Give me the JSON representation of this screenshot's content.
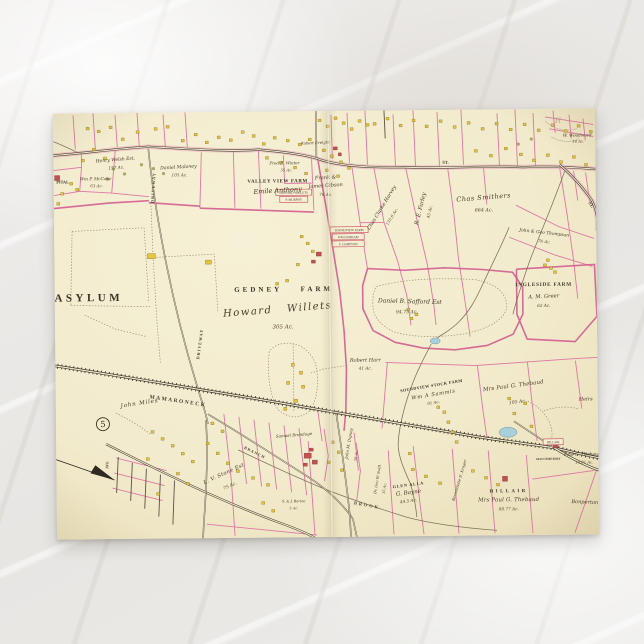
{
  "scene": {
    "description": "vintage atlas map postcard on white marble surface",
    "colors": {
      "marble_background": "#e9e7e4",
      "paper": "#f2ebcd",
      "parcel_pink": "#df76a3",
      "building_yellow": "#e8c43c",
      "building_red": "#c2504f",
      "water_blue": "#a8d0dc",
      "road_dark": "#4a4234"
    }
  },
  "postcard": {
    "kind": "vintage-atlas-map-postcard",
    "plate_number": "5"
  },
  "map": {
    "plate_number": "5",
    "labels": [
      {
        "id": "asylum",
        "t": "ASYLUM",
        "x": 34,
        "y": 188,
        "fs": 11,
        "ls": 3.5,
        "cls": "c"
      },
      {
        "id": "gedney-farm",
        "t": "GEDNEY FARM",
        "x": 229,
        "y": 180,
        "fs": 7,
        "ls": 3,
        "ws": 14,
        "cls": "c"
      },
      {
        "id": "howard-willets",
        "t": "Howard Willets",
        "x": 223,
        "y": 201,
        "fs": 10,
        "ls": 1.5,
        "ws": 10,
        "rot": -4,
        "cls": "s"
      },
      {
        "id": "gedney-acre",
        "t": "305 Ac.",
        "x": 228,
        "y": 217,
        "fs": 5.5,
        "cls": "a"
      },
      {
        "id": "valley-view-farm",
        "t": "VALLEY VIEW FARM",
        "x": 224,
        "y": 71,
        "fs": 5,
        "ls": 0.6,
        "cls": "c"
      },
      {
        "id": "emile-anthony",
        "t": "Emile Anthony",
        "x": 224,
        "y": 81,
        "fs": 6.5,
        "rot": -3,
        "cls": "s"
      },
      {
        "id": "henry-welsh",
        "t": "Henry Welsh Est.",
        "x": 62,
        "y": 48,
        "fs": 4.5,
        "rot": -4,
        "cls": "s"
      },
      {
        "id": "henry-welsh-acre",
        "t": "157 Ac.",
        "x": 63,
        "y": 56,
        "fs": 4.2,
        "rot": -4,
        "cls": "a"
      },
      {
        "id": "daniel-maloney",
        "t": "Daniel Maloney",
        "x": 125,
        "y": 56,
        "fs": 4.6,
        "rot": -3,
        "cls": "s"
      },
      {
        "id": "maloney-acre",
        "t": "105 Ac.",
        "x": 126,
        "y": 64,
        "fs": 4.2,
        "cls": "a"
      },
      {
        "id": "mccabe",
        "t": "Wm P. McCabe",
        "x": 42,
        "y": 67,
        "fs": 4.2,
        "cls": "s"
      },
      {
        "id": "mccabe-acre",
        "t": "63 Ac.",
        "x": 43,
        "y": 74,
        "fs": 4,
        "cls": "a"
      },
      {
        "id": "hospital-frag",
        "t": "PITAL",
        "x": 9,
        "y": 70,
        "fs": 4.2,
        "cls": "c"
      },
      {
        "id": "winter",
        "t": "Fred E. Winter",
        "x": 231,
        "y": 53,
        "fs": 4,
        "cls": "s"
      },
      {
        "id": "winter-acre",
        "t": "55 Ac.",
        "x": 233,
        "y": 60,
        "fs": 3.8,
        "cls": "a"
      },
      {
        "id": "gibson-1",
        "t": "Frank &",
        "x": 272,
        "y": 68,
        "fs": 5,
        "rot": -3,
        "cls": "s"
      },
      {
        "id": "gibson-2",
        "t": "James Gibson",
        "x": 272,
        "y": 76,
        "fs": 5,
        "rot": -3,
        "cls": "s"
      },
      {
        "id": "gibson-acre",
        "t": "76 Ac.",
        "x": 272,
        "y": 85,
        "fs": 4.2,
        "cls": "a"
      },
      {
        "id": "creight",
        "t": "Robert Creight",
        "x": 262,
        "y": 33,
        "fs": 3.8,
        "rot": -2,
        "cls": "s"
      },
      {
        "id": "harvey",
        "t": "Chas Clarke Harvey",
        "x": 329,
        "y": 98,
        "fs": 5,
        "rot": -58,
        "cls": "s"
      },
      {
        "id": "harvey-acre",
        "t": "135.6 Ac.",
        "x": 339,
        "y": 107,
        "fs": 4,
        "rot": -58,
        "cls": "a"
      },
      {
        "id": "farley",
        "t": "R. E. Farley",
        "x": 368,
        "y": 99,
        "fs": 5.6,
        "rot": -76,
        "cls": "s"
      },
      {
        "id": "farley-acre",
        "t": "45 Ac.",
        "x": 377,
        "y": 102,
        "fs": 4.2,
        "rot": -76,
        "cls": "a"
      },
      {
        "id": "smithers",
        "t": "Chas Smithers",
        "x": 430,
        "y": 90,
        "fs": 6.5,
        "rot": -4,
        "ls": 0.5,
        "cls": "s"
      },
      {
        "id": "smithers-acre",
        "t": "664 Ac.",
        "x": 430,
        "y": 102,
        "fs": 4.8,
        "cls": "a"
      },
      {
        "id": "thompson",
        "t": "John & Geo Thompson",
        "x": 490,
        "y": 125,
        "fs": 4.4,
        "rot": 7,
        "cls": "s"
      },
      {
        "id": "thompson-acre",
        "t": "76 Ac.",
        "x": 490,
        "y": 134,
        "fs": 4,
        "rot": 7,
        "cls": "a"
      },
      {
        "id": "woodward",
        "t": "W. Woodward",
        "x": 524,
        "y": 28,
        "fs": 4.2,
        "cls": "s"
      },
      {
        "id": "woodward-acre",
        "t": "14 Ac.",
        "x": 525,
        "y": 34,
        "fs": 3.8,
        "cls": "a"
      },
      {
        "id": "ingleside-farm",
        "t": "INGLESIDE FARM",
        "x": 489,
        "y": 177,
        "fs": 5.2,
        "ls": 0.8,
        "cls": "c"
      },
      {
        "id": "greer",
        "t": "A. M. Greer",
        "x": 489,
        "y": 189,
        "fs": 5.2,
        "rot": -2,
        "cls": "s"
      },
      {
        "id": "greer-acre",
        "t": "62 Ac.",
        "x": 489,
        "y": 198,
        "fs": 4.2,
        "cls": "a"
      },
      {
        "id": "safford",
        "t": "Daniel B. Safford Est",
        "x": 355,
        "y": 193,
        "fs": 6,
        "rot": 2,
        "cls": "s"
      },
      {
        "id": "safford-acre",
        "t": "94.75 Ac.",
        "x": 352,
        "y": 203,
        "fs": 4.6,
        "cls": "a"
      },
      {
        "id": "harr",
        "t": "Robert Harr",
        "x": 310,
        "y": 251,
        "fs": 5,
        "cls": "s"
      },
      {
        "id": "harr-acre",
        "t": "41 Ac.",
        "x": 310,
        "y": 259,
        "fs": 4.2,
        "cls": "a"
      },
      {
        "id": "soundview",
        "t": "SOUNDVIEW STOCK FARM",
        "x": 376,
        "y": 277,
        "fs": 4.2,
        "ls": 0.4,
        "rot": -9,
        "cls": "c"
      },
      {
        "id": "sammis",
        "t": "Wm A Sammis",
        "x": 378,
        "y": 286,
        "fs": 5.2,
        "ls": 0.6,
        "rot": -9,
        "cls": "s"
      },
      {
        "id": "sammis-acre",
        "t": "91 Ac.",
        "x": 378,
        "y": 294,
        "fs": 4,
        "rot": -9,
        "cls": "a"
      },
      {
        "id": "thebaud-n",
        "t": "Mrs Paul G. Thebaud",
        "x": 458,
        "y": 278,
        "fs": 5.4,
        "ls": 0.2,
        "rot": -7,
        "cls": "s"
      },
      {
        "id": "thebaud-n-acre",
        "t": "195 Ac.",
        "x": 462,
        "y": 294,
        "fs": 4.6,
        "rot": -7,
        "cls": "a"
      },
      {
        "id": "heirs",
        "t": "Heirs",
        "x": 530,
        "y": 292,
        "fs": 5,
        "cls": "s"
      },
      {
        "id": "john-miles",
        "t": "John Miles",
        "x": 84,
        "y": 292,
        "fs": 5.6,
        "ls": 0.8,
        "rot": -8,
        "cls": "s"
      },
      {
        "id": "stone",
        "t": "L. V. Stone Est",
        "x": 168,
        "y": 363,
        "fs": 5.2,
        "ls": 0.4,
        "rot": -24,
        "cls": "s"
      },
      {
        "id": "stone-acre",
        "t": "75 Ac.",
        "x": 174,
        "y": 375,
        "fs": 4.4,
        "rot": -24,
        "cls": "a"
      },
      {
        "id": "glen-alla",
        "t": "GLEN ALLA",
        "x": 352,
        "y": 376,
        "fs": 4.2,
        "ls": 0.8,
        "rot": -7,
        "cls": "c"
      },
      {
        "id": "bayne",
        "t": "G. Bayne",
        "x": 352,
        "y": 384,
        "fs": 5.6,
        "rot": -7,
        "cls": "s"
      },
      {
        "id": "bayne-acre",
        "t": "44.5 Ac.",
        "x": 352,
        "y": 392,
        "fs": 4.2,
        "rot": -7,
        "cls": "a"
      },
      {
        "id": "hillair",
        "t": "HILLAIR",
        "x": 452,
        "y": 383,
        "fs": 4.8,
        "ls": 2.5,
        "cls": "c"
      },
      {
        "id": "thebaud-s",
        "t": "Mrs Paul G. Thebaud",
        "x": 452,
        "y": 392,
        "fs": 5.4,
        "ls": 0.2,
        "cls": "s"
      },
      {
        "id": "thebaud-s-acre",
        "t": "88.77 Ac.",
        "x": 452,
        "y": 401,
        "fs": 4.2,
        "cls": "a"
      },
      {
        "id": "thebaud-rail",
        "t": "Paul G. Thebaud",
        "x": 526,
        "y": 347,
        "fs": 4.4,
        "cls": "s"
      },
      {
        "id": "thebaud-rail-acre",
        "t": "14.81 Ac.",
        "x": 528,
        "y": 355,
        "fs": 3.8,
        "cls": "a"
      },
      {
        "id": "bonperton",
        "t": "Bonperton",
        "x": 528,
        "y": 395,
        "fs": 5,
        "rot": 3,
        "cls": "s"
      },
      {
        "id": "mamaroneck",
        "t": "MAMARONECK",
        "x": 122,
        "y": 290,
        "fs": 5.5,
        "ls": 1.5,
        "rot": 9,
        "cls": "r"
      },
      {
        "id": "driveway-1",
        "t": "DRIVEWAY",
        "x": 101,
        "y": 75,
        "fs": 4.2,
        "ls": 1,
        "rot": -86,
        "cls": "r"
      },
      {
        "id": "driveway-2",
        "t": "DRIVEWAY",
        "x": 146,
        "y": 232,
        "fs": 4.2,
        "ls": 1,
        "rot": -82,
        "cls": "r"
      },
      {
        "id": "st-1",
        "t": "ST.",
        "x": 392,
        "y": 54,
        "fs": 4.6,
        "rot": 2,
        "cls": "r"
      },
      {
        "id": "st-2",
        "t": "ST.",
        "x": 536,
        "y": 97,
        "fs": 4.4,
        "rot": 55,
        "cls": "r"
      },
      {
        "id": "brook",
        "t": "BROOK",
        "x": 310,
        "y": 396,
        "fs": 4.4,
        "ls": 2,
        "rot": 11,
        "cls": "r"
      },
      {
        "id": "branch",
        "t": "BRANCH",
        "x": 198,
        "y": 342,
        "fs": 4,
        "ls": 1,
        "rot": 27,
        "cls": "r"
      },
      {
        "id": "ave",
        "t": "AVE",
        "x": 52,
        "y": 352,
        "fs": 3.8,
        "rot": -88,
        "cls": "r"
      },
      {
        "id": "digney",
        "t": "John M. Digney",
        "x": 294,
        "y": 333,
        "fs": 4,
        "rot": -80,
        "cls": "s"
      },
      {
        "id": "digney-acre",
        "t": "38 Ac.",
        "x": 301,
        "y": 345,
        "fs": 3.6,
        "rot": -80,
        "cls": "a"
      },
      {
        "id": "swift",
        "t": "Dr. Geo W. Swift",
        "x": 322,
        "y": 369,
        "fs": 3.6,
        "rot": -80,
        "cls": "s"
      },
      {
        "id": "swift-acre",
        "t": "35 Ac.",
        "x": 329,
        "y": 378,
        "fs": 3.6,
        "rot": -80,
        "cls": "a"
      },
      {
        "id": "kroger",
        "t": "Bernardette E. Kroger",
        "x": 404,
        "y": 371,
        "fs": 3.8,
        "rot": -73,
        "cls": "s"
      },
      {
        "id": "barton",
        "t": "S. & J. Barton",
        "x": 237,
        "y": 391,
        "fs": 3.4,
        "cls": "s"
      },
      {
        "id": "barton-acre",
        "t": "5 Ac.",
        "x": 237,
        "y": 398,
        "fs": 3.4,
        "cls": "a"
      },
      {
        "id": "brundage",
        "t": "Samuel Brundage",
        "x": 238,
        "y": 325,
        "fs": 4,
        "rot": -4,
        "cls": "s"
      },
      {
        "id": "old-cemetery",
        "t": "OLD CEMETERY",
        "x": 492,
        "y": 351,
        "fs": 3,
        "cls": "c"
      },
      {
        "id": "plate-number",
        "t": "5",
        "x": 47,
        "y": 314,
        "fs": 8.5,
        "cls": "p"
      },
      {
        "id": "pencil-h",
        "t": "H",
        "x": 505,
        "y": 14,
        "fs": 7,
        "cls": "pe"
      }
    ],
    "boxed_labels": [
      {
        "t": "HOWARD WILLETS",
        "x": 222,
        "y": 78,
        "w": 36,
        "h": 6
      },
      {
        "t": "P. MURPHY",
        "x": 226,
        "y": 85,
        "w": 28,
        "h": 6
      },
      {
        "t": "SOUNDVIEW FARM",
        "x": 276,
        "y": 116,
        "w": 38,
        "h": 6
      },
      {
        "t": "WM DURHAM",
        "x": 278,
        "y": 123,
        "w": 32,
        "h": 6
      },
      {
        "t": "F. COMPTON",
        "x": 278,
        "y": 130,
        "w": 32,
        "h": 6
      },
      {
        "t": "HILLAIR",
        "x": 487,
        "y": 330,
        "w": 20,
        "h": 6
      }
    ],
    "buildings": [
      [
        33,
        14
      ],
      [
        44,
        17
      ],
      [
        56,
        13
      ],
      [
        68,
        25
      ],
      [
        83,
        18
      ],
      [
        101,
        15
      ],
      [
        113,
        13
      ],
      [
        39,
        35
      ],
      [
        16,
        69
      ],
      [
        22,
        75
      ],
      [
        7,
        79
      ],
      [
        3,
        89
      ],
      [
        28,
        46
      ],
      [
        50,
        44
      ],
      [
        128,
        27
      ],
      [
        141,
        21
      ],
      [
        152,
        29
      ],
      [
        164,
        24
      ],
      [
        176,
        27
      ],
      [
        188,
        19
      ],
      [
        199,
        23
      ],
      [
        209,
        31
      ],
      [
        220,
        25
      ],
      [
        233,
        28
      ],
      [
        245,
        32
      ],
      [
        255,
        27
      ],
      [
        212,
        45
      ],
      [
        226,
        50
      ],
      [
        240,
        55
      ],
      [
        251,
        61
      ],
      [
        265,
        8
      ],
      [
        273,
        14
      ],
      [
        281,
        6
      ],
      [
        289,
        11
      ],
      [
        297,
        17
      ],
      [
        305,
        9
      ],
      [
        313,
        13
      ],
      [
        269,
        38
      ],
      [
        277,
        44
      ],
      [
        286,
        50
      ],
      [
        294,
        56
      ],
      [
        272,
        58
      ],
      [
        283,
        64
      ],
      [
        320,
        12
      ],
      [
        333,
        7
      ],
      [
        346,
        14
      ],
      [
        359,
        9
      ],
      [
        372,
        15
      ],
      [
        386,
        10
      ],
      [
        400,
        16
      ],
      [
        414,
        12
      ],
      [
        428,
        18
      ],
      [
        442,
        13
      ],
      [
        456,
        19
      ],
      [
        470,
        14
      ],
      [
        484,
        20
      ],
      [
        498,
        15
      ],
      [
        511,
        21
      ],
      [
        524,
        16
      ],
      [
        536,
        22
      ],
      [
        421,
        40
      ],
      [
        436,
        45
      ],
      [
        451,
        38
      ],
      [
        466,
        44
      ],
      [
        479,
        50
      ],
      [
        493,
        45
      ],
      [
        506,
        52
      ],
      [
        519,
        47
      ],
      [
        531,
        55
      ],
      [
        93,
        141,
        8,
        5
      ],
      [
        151,
        148,
        6,
        4
      ],
      [
        242,
        152
      ],
      [
        231,
        168
      ],
      [
        221,
        171
      ],
      [
        257,
        139
      ],
      [
        352,
        198
      ],
      [
        360,
        203
      ],
      [
        355,
        207
      ],
      [
        489,
        155
      ],
      [
        495,
        158
      ],
      [
        499,
        162
      ],
      [
        492,
        150
      ],
      [
        381,
        296
      ],
      [
        387,
        301
      ],
      [
        391,
        311
      ],
      [
        395,
        321
      ],
      [
        399,
        331
      ],
      [
        452,
        288
      ],
      [
        468,
        293
      ],
      [
        457,
        303
      ],
      [
        474,
        316
      ],
      [
        95,
        318
      ],
      [
        105,
        325
      ],
      [
        115,
        332
      ],
      [
        125,
        340
      ],
      [
        135,
        348
      ],
      [
        150,
        330
      ],
      [
        160,
        340
      ],
      [
        170,
        350
      ],
      [
        180,
        358
      ],
      [
        195,
        365
      ],
      [
        210,
        372
      ],
      [
        155,
        310
      ],
      [
        165,
        318
      ],
      [
        120,
        360
      ],
      [
        130,
        370
      ],
      [
        90,
        345
      ],
      [
        100,
        380
      ],
      [
        205,
        390
      ],
      [
        215,
        398
      ],
      [
        275,
        330
      ],
      [
        281,
        340
      ],
      [
        271,
        350
      ],
      [
        284,
        358
      ],
      [
        355,
        358
      ],
      [
        368,
        365
      ],
      [
        382,
        372
      ],
      [
        415,
        360
      ],
      [
        428,
        367
      ],
      [
        440,
        374
      ],
      [
        352,
        342
      ],
      [
        246,
        124
      ],
      [
        252,
        131
      ],
      [
        236,
        252,
        3,
        3
      ],
      [
        244,
        260,
        3,
        3
      ],
      [
        231,
        270,
        3,
        3
      ],
      [
        246,
        274,
        3,
        3
      ],
      [
        238,
        288,
        4,
        3
      ],
      [
        228,
        296,
        3,
        3
      ],
      [
        262,
        141,
        5,
        4,
        "r"
      ],
      [
        257,
        149,
        4,
        3,
        "r"
      ],
      [
        280,
        36,
        4,
        3,
        "r"
      ],
      [
        285,
        42,
        3,
        3,
        "r"
      ],
      [
        248,
        342,
        7,
        5,
        "r"
      ],
      [
        256,
        349,
        5,
        4,
        "r"
      ],
      [
        247,
        352,
        4,
        3,
        "r"
      ],
      [
        253,
        337,
        4,
        3,
        "r"
      ],
      [
        497,
        336,
        5,
        3,
        "r"
      ],
      [
        446,
        367,
        5,
        5,
        "r"
      ],
      [
        1,
        62,
        5,
        5,
        "r"
      ]
    ],
    "trees": [
      [
        60,
        56
      ],
      [
        71,
        61
      ],
      [
        54,
        66
      ],
      [
        100,
        56
      ],
      [
        110,
        61
      ],
      [
        88,
        52
      ],
      [
        465,
        35
      ],
      [
        478,
        30
      ]
    ],
    "ponds": [
      {
        "x": 380,
        "y": 231,
        "rx": 5,
        "ry": 3
      },
      {
        "x": 452,
        "y": 323,
        "rx": 9,
        "ry": 5
      }
    ]
  }
}
